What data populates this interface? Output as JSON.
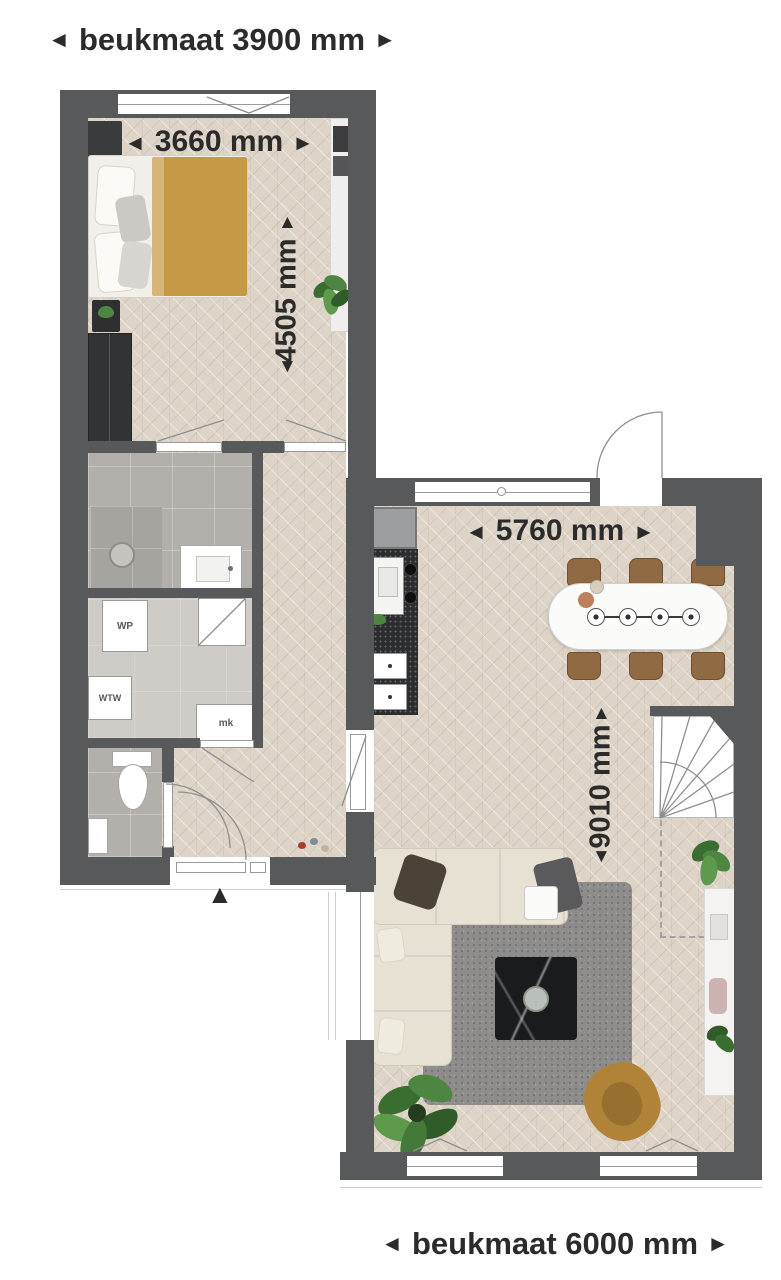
{
  "meta": {
    "type": "floor-plan",
    "language": "nl"
  },
  "dim": {
    "top": "beukmaat 3900 mm",
    "bottom": "beukmaat 6000 mm",
    "bedroom_w": "3660 mm",
    "bedroom_d": "4505 mm",
    "living_w": "5760 mm",
    "living_d": "9010 mm"
  },
  "arrows": {
    "left": "◄",
    "right": "►",
    "up": "▲",
    "down": "▼"
  },
  "rooms": {
    "wp": "WP",
    "wtw": "WTW",
    "mk": "mk"
  },
  "colors": {
    "wall": "#58595b",
    "floor_wood": "#ddd3c7",
    "floor_tile": "#b3b0ab",
    "floor_tech": "#cfccc7",
    "counter": "#2c2d2f",
    "rug": "#8e8d8b",
    "sofa": "#e7e1d4",
    "text": "#2b2b2b",
    "duvet": "#c69a44",
    "chair_wood": "#8f6a42",
    "armchair": "#b08339",
    "plant": "#4e8040",
    "table_black": "#1a1b1d",
    "sideboard": "#f4f3f1"
  }
}
